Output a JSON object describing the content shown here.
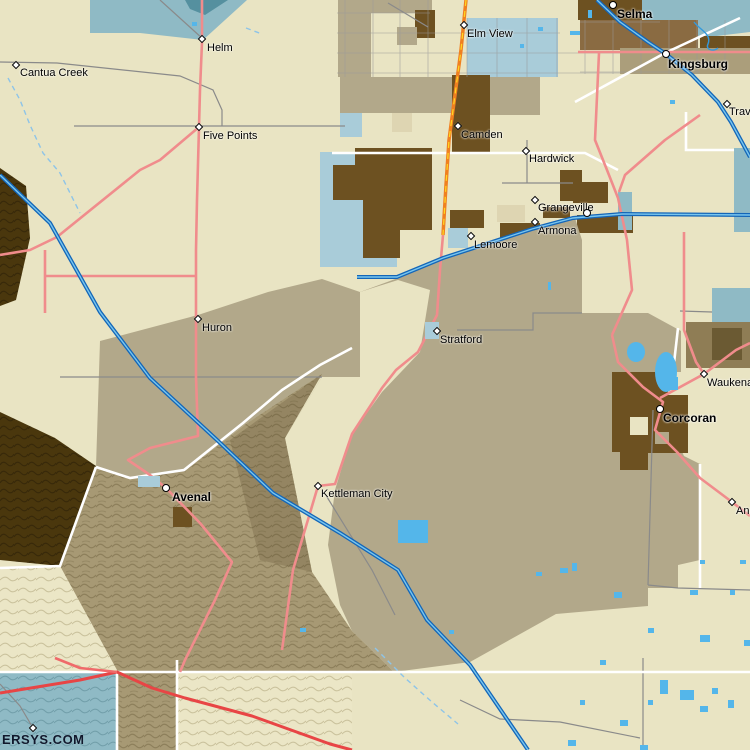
{
  "map_title": "Central Valley area map (Selma / Lemoore / Corcoran / Avenal region)",
  "watermark": {
    "text": "ERSYS.COM",
    "x": 2,
    "y": 732
  },
  "colors": {
    "bg": "#e9e4c3",
    "tan": "#b2a88a",
    "sandy": "#ded5b2",
    "kingsburg_tan": "#ab9e7b",
    "brown_dark": "#6d5121",
    "brown_mid": "#8a6b42",
    "tan_right": "#8f7d55",
    "tan_right_dark": "#6b5a33",
    "teal": "#8fbac5",
    "teal_dark": "#55909f",
    "parcel_blue": "#a9ccd9",
    "pond_blue": "#54b6ea",
    "hills_tan": "#a79974",
    "hills_dark": "#4a370d",
    "cream_hills": "#ebe6c6",
    "road_pink": "#f08c8c",
    "road_red": "#e84545",
    "road_orange": "#f08020",
    "road_yellow": "#ffd820",
    "hwy_blue_outer": "#1466b8",
    "hwy_blue_inner": "#79c6ee",
    "creek_blue": "#8ec4e8",
    "road_gray": "#8a8a8a",
    "road_white": "#ffffff",
    "label": "#000000",
    "watermark": "#10182c"
  },
  "towns": [
    {
      "name": "Selma",
      "marker": "circle",
      "bold": true,
      "mx": 613,
      "my": 5,
      "lx": 617,
      "ly": 8
    },
    {
      "name": "Kingsburg",
      "marker": "circle",
      "bold": true,
      "mx": 666,
      "my": 54,
      "lx": 668,
      "ly": 58
    },
    {
      "name": "Traver",
      "marker": "diamond",
      "bold": false,
      "mx": 727,
      "my": 104,
      "lx": 729,
      "ly": 107
    },
    {
      "name": "Helm",
      "marker": "diamond",
      "bold": false,
      "mx": 202,
      "my": 39,
      "lx": 207,
      "ly": 43
    },
    {
      "name": "Cantua Creek",
      "marker": "diamond",
      "bold": false,
      "mx": 16,
      "my": 65,
      "lx": 20,
      "ly": 68
    },
    {
      "name": "Five Points",
      "marker": "diamond",
      "bold": false,
      "mx": 199,
      "my": 127,
      "lx": 203,
      "ly": 131
    },
    {
      "name": "Elm View",
      "marker": "diamond",
      "bold": false,
      "mx": 464,
      "my": 25,
      "lx": 467,
      "ly": 29
    },
    {
      "name": "Camden",
      "marker": "diamond",
      "bold": false,
      "mx": 458,
      "my": 126,
      "lx": 461,
      "ly": 130
    },
    {
      "name": "Hardwick",
      "marker": "diamond",
      "bold": false,
      "mx": 526,
      "my": 151,
      "lx": 529,
      "ly": 154
    },
    {
      "name": "Grangeville",
      "marker": "diamond",
      "bold": false,
      "mx": 535,
      "my": 200,
      "lx": 538,
      "ly": 203
    },
    {
      "name": "Armona",
      "marker": "diamond",
      "bold": false,
      "mx": 535,
      "my": 222,
      "lx": 538,
      "ly": 226
    },
    {
      "name": "Lemoore",
      "marker": "diamond",
      "bold": false,
      "mx": 471,
      "my": 236,
      "lx": 474,
      "ly": 240
    },
    {
      "name": "Stratford",
      "marker": "diamond",
      "bold": false,
      "mx": 437,
      "my": 331,
      "lx": 440,
      "ly": 335
    },
    {
      "name": "Huron",
      "marker": "diamond",
      "bold": false,
      "mx": 198,
      "my": 319,
      "lx": 202,
      "ly": 323
    },
    {
      "name": "Waukena",
      "marker": "diamond",
      "bold": false,
      "mx": 704,
      "my": 374,
      "lx": 707,
      "ly": 378
    },
    {
      "name": "Corcoran",
      "marker": "circle",
      "bold": true,
      "mx": 660,
      "my": 409,
      "lx": 663,
      "ly": 412
    },
    {
      "name": "Avenal",
      "marker": "circle",
      "bold": true,
      "mx": 166,
      "my": 488,
      "lx": 172,
      "ly": 491
    },
    {
      "name": "Kettleman City",
      "marker": "diamond",
      "bold": false,
      "mx": 318,
      "my": 486,
      "lx": 321,
      "ly": 489
    },
    {
      "name": "Angiola",
      "marker": "diamond",
      "bold": false,
      "mx": 732,
      "my": 502,
      "lx": 736,
      "ly": 506
    }
  ],
  "unlabeled_markers": [
    {
      "marker": "circle",
      "mx": 587,
      "my": 213
    },
    {
      "marker": "diamond",
      "mx": 33,
      "my": 728
    }
  ]
}
